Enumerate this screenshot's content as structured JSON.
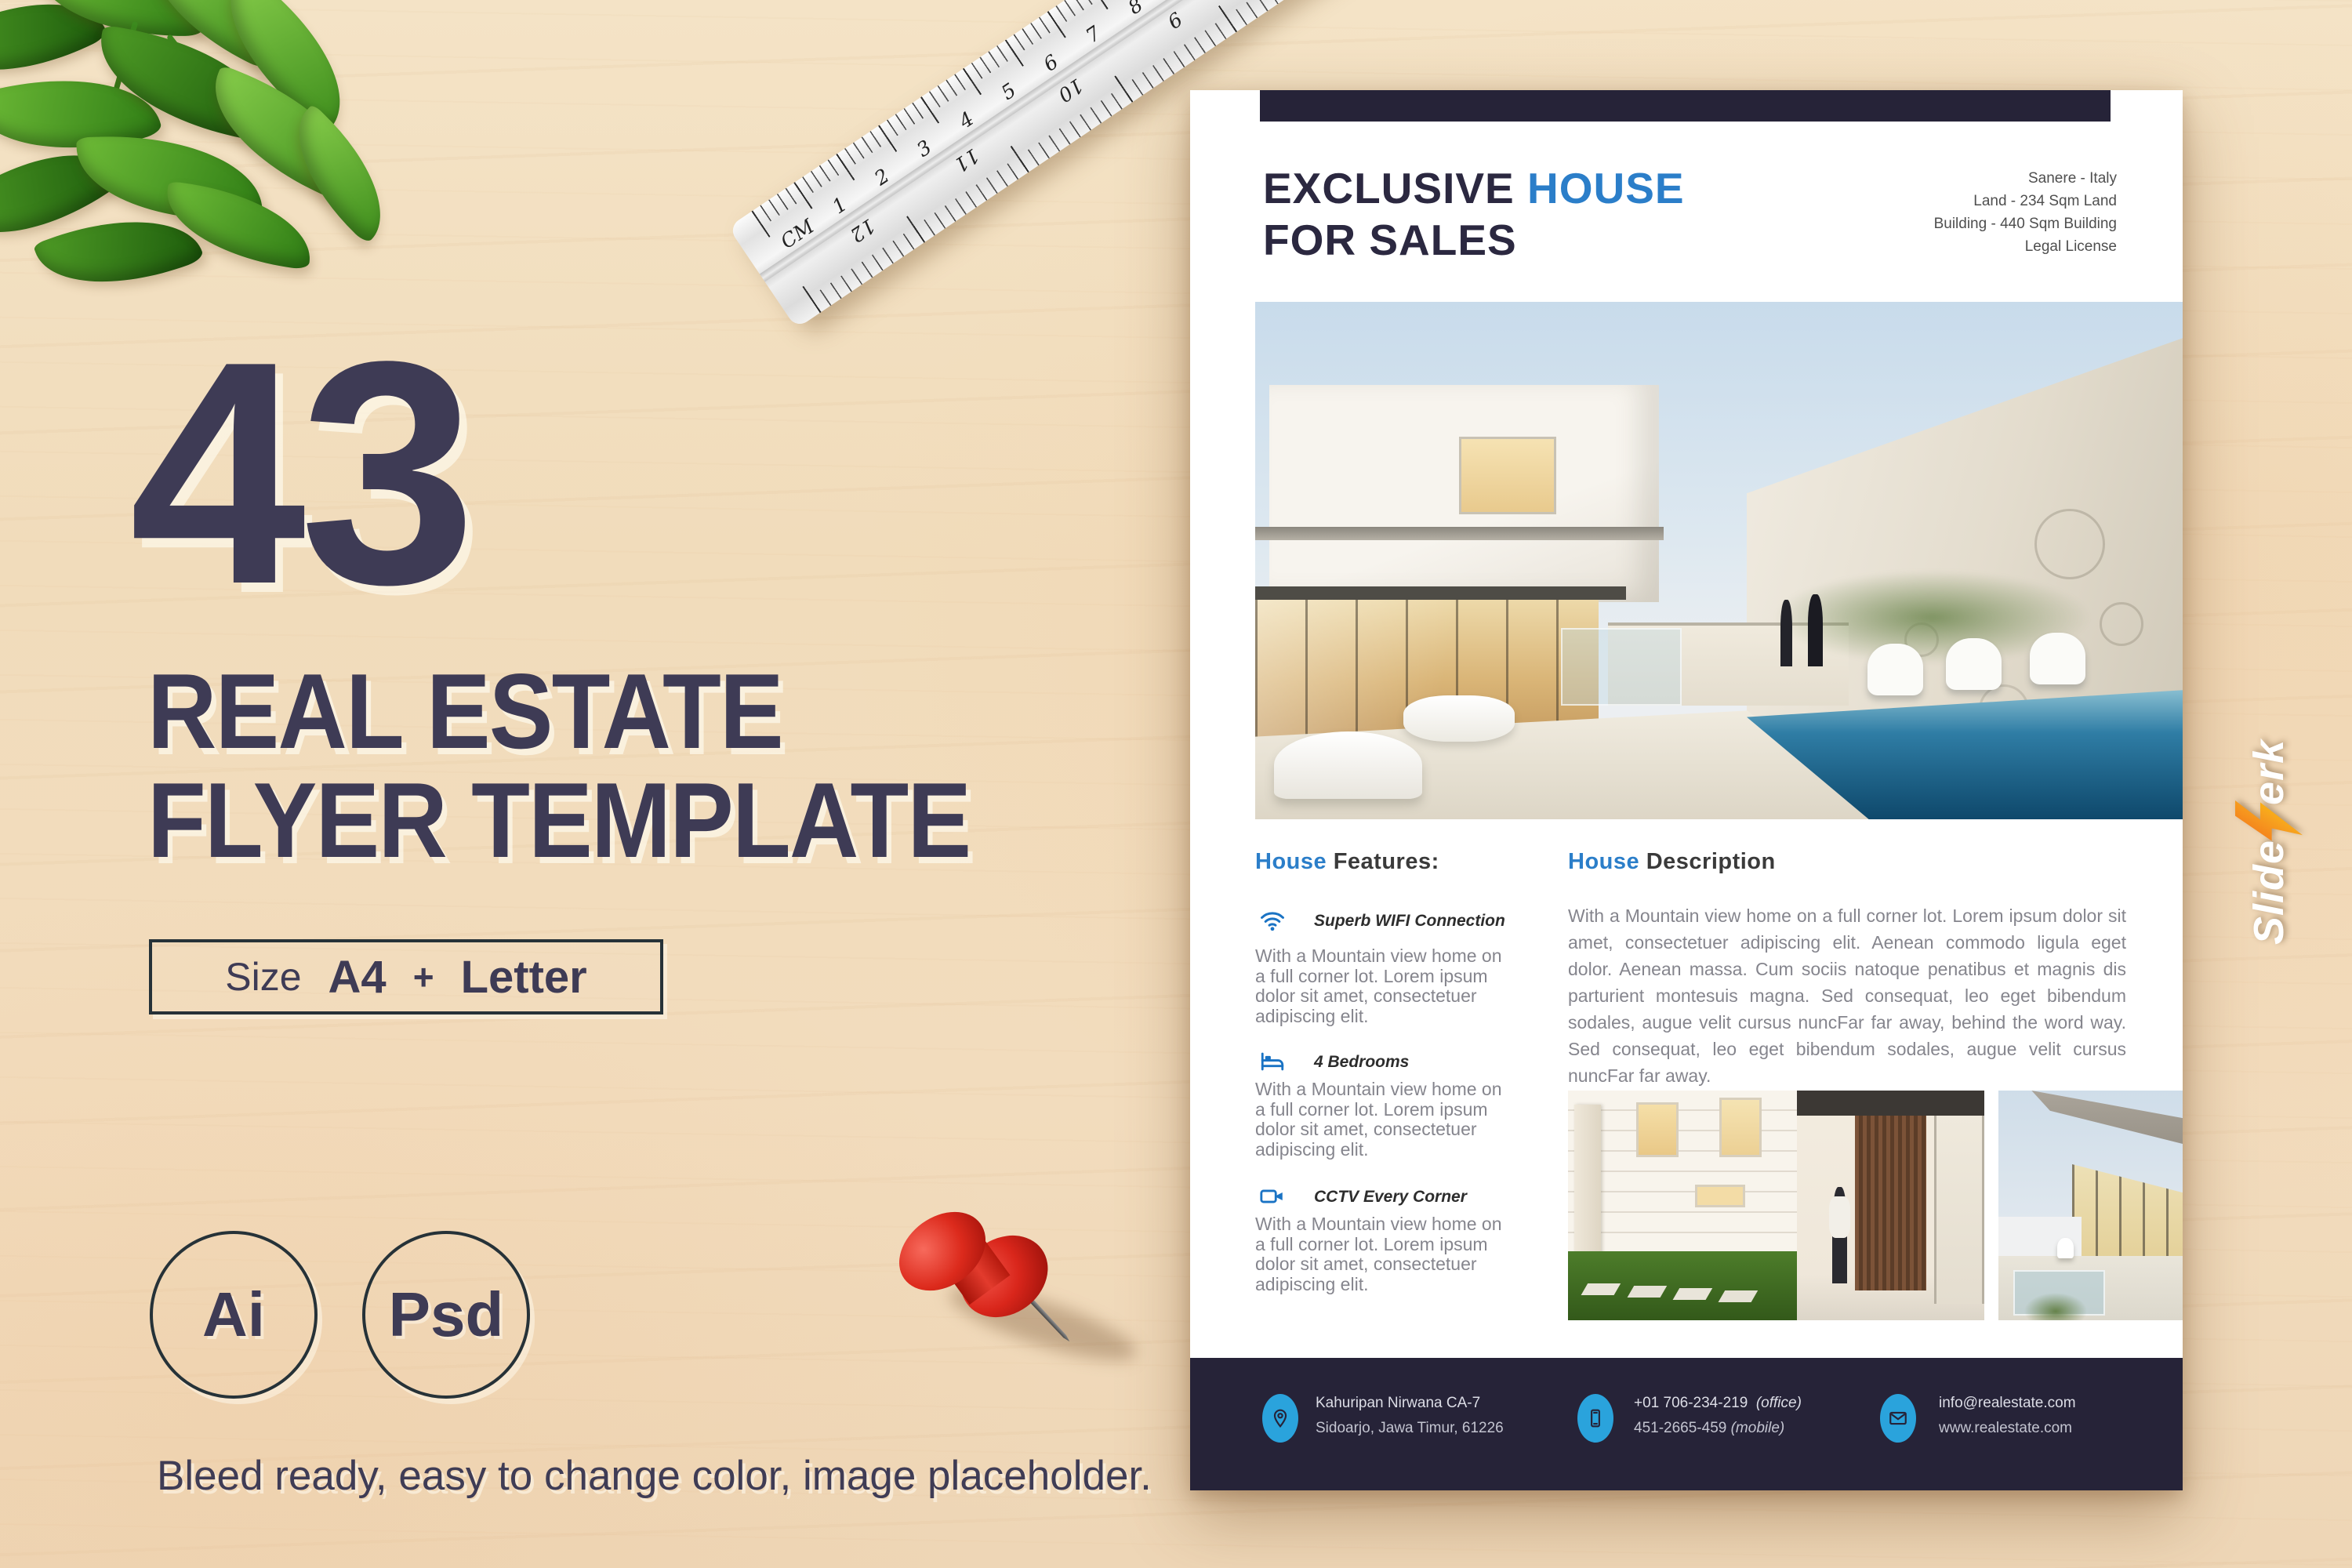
{
  "left_panel": {
    "big_number": "43",
    "title_line1": "REAL ESTATE",
    "title_line2": "FLYER TEMPLATE",
    "size_box": {
      "label": "Size",
      "format1": "A4",
      "separator": "+",
      "format2": "Letter"
    },
    "badges": [
      {
        "label": "Ai"
      },
      {
        "label": "Psd"
      }
    ],
    "footnote": "Bleed ready, easy to change color, image placeholder."
  },
  "ruler": {
    "unit": "CM",
    "top_numbers": [
      "1",
      "2",
      "3",
      "4",
      "5",
      "6",
      "7",
      "8",
      "9",
      "10",
      "11",
      "12",
      "13",
      "14"
    ],
    "bottom_numbers": [
      "12",
      "11",
      "10",
      "9",
      "8",
      "7"
    ]
  },
  "flyer": {
    "header": {
      "title_part1": "EXCLUSIVE",
      "title_accent": "HOUSE",
      "title_line2": "FOR SALES",
      "info_lines": [
        "Sanere - Italy",
        "Land - 234 Sqm Land",
        "Building - 440 Sqm Building",
        "Legal License"
      ]
    },
    "features": {
      "heading_accent": "House",
      "heading_rest": "Features:",
      "items": [
        {
          "icon": "wifi-icon",
          "title": "Superb WIFI Connection",
          "desc": "With a Mountain view home on a full corner lot. Lorem ipsum dolor sit amet, consectetuer adipiscing elit."
        },
        {
          "icon": "bed-icon",
          "title": "4 Bedrooms",
          "desc": "With a Mountain view home on a full corner lot. Lorem ipsum dolor sit amet, consectetuer adipiscing elit."
        },
        {
          "icon": "cctv-icon",
          "title": "CCTV Every Corner",
          "desc": "With a Mountain view home on a full corner lot. Lorem ipsum dolor sit amet, consectetuer adipiscing elit."
        }
      ]
    },
    "description": {
      "heading_accent": "House",
      "heading_rest": "Description",
      "body": "With a Mountain view home on a full corner lot. Lorem ipsum dolor sit amet, consectetuer adipiscing elit. Aenean commodo ligula eget dolor. Aenean massa. Cum sociis natoque penatibus et magnis dis parturient montesuis magna. Sed consequat, leo eget bibendum sodales, augue velit cursus nuncFar far away, behind the word way. Sed consequat, leo eget bibendum sodales, augue velit cursus nuncFar far away."
    },
    "footer": {
      "address": {
        "icon": "location-icon",
        "line1": "Kahuripan Nirwana CA-7",
        "line2": "Sidoarjo, Jawa Timur, 61226"
      },
      "phone": {
        "icon": "phone-icon",
        "line1_number": "+01 706-234-219",
        "line1_label": "(office)",
        "line2_number": "451-2665-459",
        "line2_label": "(mobile)"
      },
      "email": {
        "icon": "mail-icon",
        "line1": "info@realestate.com",
        "line2": "www.realestate.com"
      }
    }
  },
  "watermark": {
    "brand_prefix": "Slide",
    "brand_suffix": "erk"
  },
  "colors": {
    "accent_blue": "#2b7ec9",
    "feature_icon_blue": "#1a73c4",
    "footer_bubble_blue": "#2aa3dc",
    "navy_band": "#262338",
    "headline_navy": "#3e3b55",
    "body_gray": "#85858d",
    "wood_background": "#f2dcbd",
    "pushpin_red": "#d9261b",
    "logo_orange": "#f7931e"
  }
}
